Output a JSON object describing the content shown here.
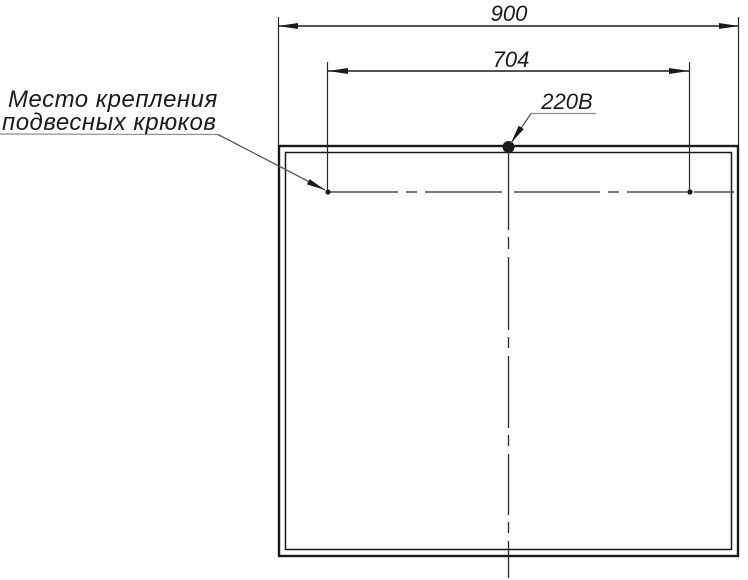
{
  "drawing": {
    "callout": {
      "line1": "Место крепления",
      "line2": "подвесных крюков"
    },
    "voltage_label": "220В",
    "dimensions": {
      "overall_width": "900",
      "hook_spacing": "704"
    },
    "colors": {
      "line": "#1a1a1a",
      "centerline": "#2a2a2a",
      "leader": "#555555",
      "underline": "#8c8c8c",
      "background": "#ffffff"
    }
  }
}
